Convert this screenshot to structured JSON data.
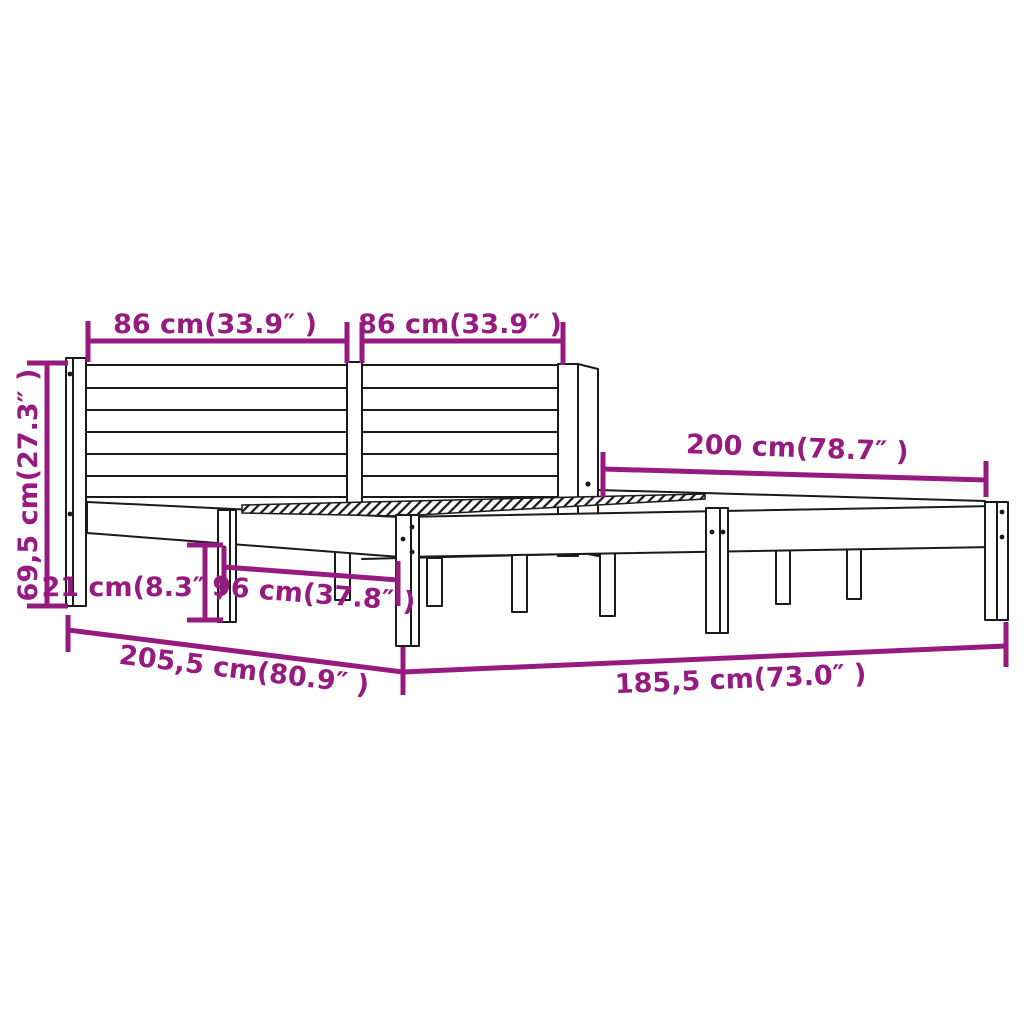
{
  "diagram": {
    "background_color": "#ffffff",
    "accent_color": "#951B81",
    "line_color": "#1a1a1a",
    "dimensions": {
      "headboard_section_left": "86 cm(33.9″ )",
      "headboard_section_right": "86 cm(33.9″ )",
      "bed_length": "200 cm(78.7″ )",
      "headboard_height": "69,5 cm(27.3″ )",
      "leg_height": "21 cm(8.3″ )",
      "leg_spacing": "96 cm(37.8″ )",
      "frame_total_length": "205,5 cm(80.9″ )",
      "frame_total_width": "185,5 cm(73.0″ )"
    }
  }
}
